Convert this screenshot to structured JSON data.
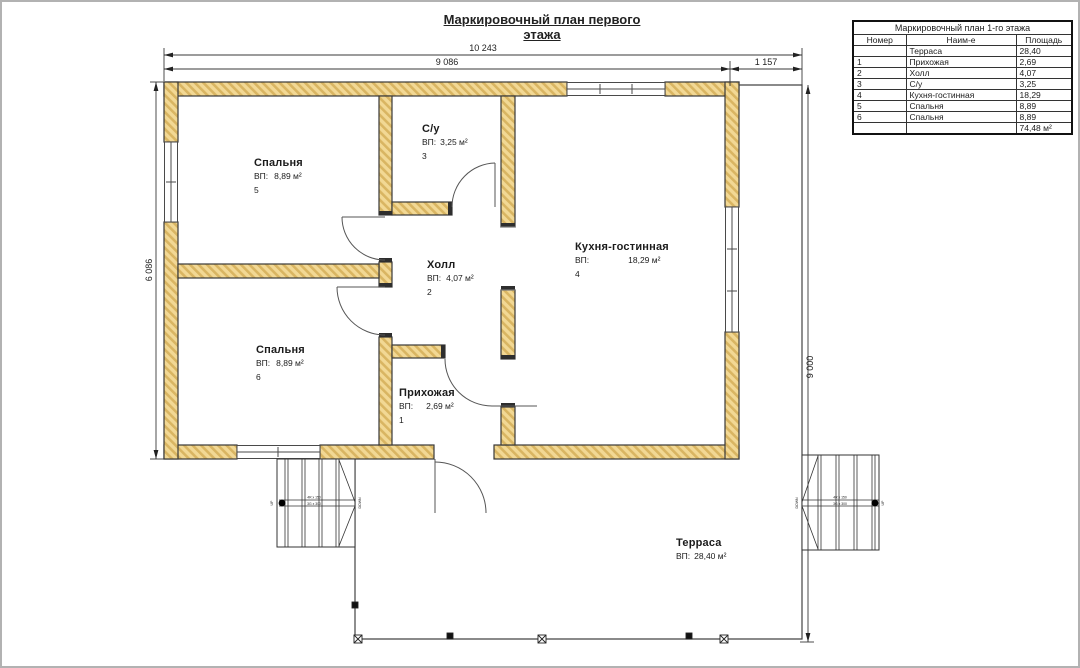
{
  "page": {
    "title_line1": "Маркировочный план первого",
    "title_line2": "этажа"
  },
  "legend_table": {
    "title": "Маркировочный план 1-го этажа",
    "headers": [
      "Номер",
      "Наим-е",
      "Площадь"
    ],
    "rows": [
      {
        "num": "",
        "name": "Терраса",
        "area": "28,40"
      },
      {
        "num": "1",
        "name": "Прихожая",
        "area": "2,69"
      },
      {
        "num": "2",
        "name": "Холл",
        "area": "4,07"
      },
      {
        "num": "3",
        "name": "С/у",
        "area": "3,25"
      },
      {
        "num": "4",
        "name": "Кухня-гостинная",
        "area": "18,29"
      },
      {
        "num": "5",
        "name": "Спальня",
        "area": "8,89"
      },
      {
        "num": "6",
        "name": "Спальня",
        "area": "8,89"
      },
      {
        "num": "",
        "name": "",
        "area": "74,48 м²"
      }
    ]
  },
  "rooms": [
    {
      "name": "Спальня",
      "vp": "ВП:",
      "area": "8,89 м²",
      "num": "5"
    },
    {
      "name": "С/у",
      "vp": "ВП:",
      "area": "3,25 м²",
      "num": "3"
    },
    {
      "name": "Кухня-гостинная",
      "vp": "ВП:",
      "area": "18,29 м²",
      "num": "4"
    },
    {
      "name": "Холл",
      "vp": "ВП:",
      "area": "4,07 м²",
      "num": "2"
    },
    {
      "name": "Спальня",
      "vp": "ВП:",
      "area": "8,89 м²",
      "num": "6"
    },
    {
      "name": "Прихожая",
      "vp": "ВП:",
      "area": "2,69 м²",
      "num": "1"
    },
    {
      "name": "Терраса",
      "vp": "ВП:",
      "area": "28,40 м²",
      "num": ""
    }
  ],
  "dimensions": {
    "top_total": "10 243",
    "top_main": "9 086",
    "top_right": "1 157",
    "left_height": "6 086",
    "right_height": "9 000"
  },
  "stairs": {
    "up": "UP",
    "down": "DOWN",
    "spec_line1": "4R x 150",
    "spec_line2": "3G x 300"
  },
  "colors": {
    "wall_fill": "#f2d894",
    "wall_hatch": "#d9b562",
    "line": "#333333"
  }
}
